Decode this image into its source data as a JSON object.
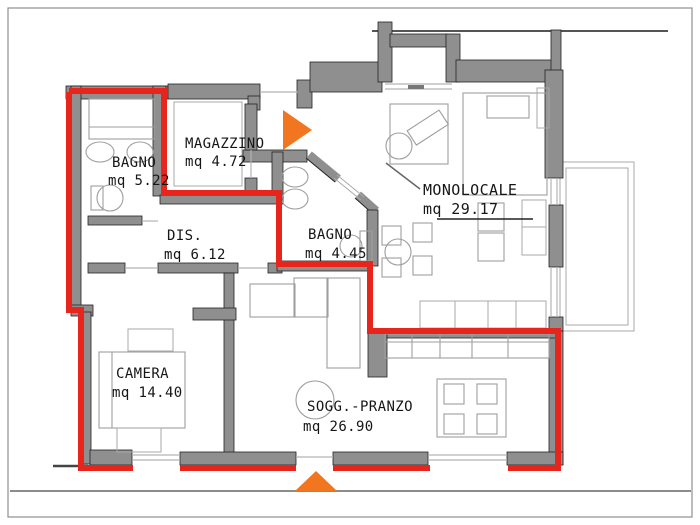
{
  "plan": {
    "rooms": [
      {
        "id": "bagno-1",
        "label": "BAGNO",
        "area": "mq 5.22"
      },
      {
        "id": "magazzino",
        "label": "MAGAZZINO",
        "area": "mq 4.72"
      },
      {
        "id": "bagno-2",
        "label": "BAGNO",
        "area": "mq 4.45"
      },
      {
        "id": "disimpegno",
        "label": "DIS.",
        "area": "mq 6.12"
      },
      {
        "id": "monolocale",
        "label": "MONOLOCALE",
        "area": "mq 29.17"
      },
      {
        "id": "camera",
        "label": "CAMERA",
        "area": "mq 14.40"
      },
      {
        "id": "soggiorno",
        "label": "SOGG.-PRANZO",
        "area": "mq 26.90"
      }
    ],
    "markers": [
      {
        "name": "entrance-arrow-top",
        "direction": "right"
      },
      {
        "name": "entrance-arrow-bottom",
        "direction": "up"
      }
    ],
    "colors": {
      "unit_boundary": "#e8251c",
      "walls": "#8f8f8f",
      "entrance_arrow": "#f1761f"
    }
  }
}
